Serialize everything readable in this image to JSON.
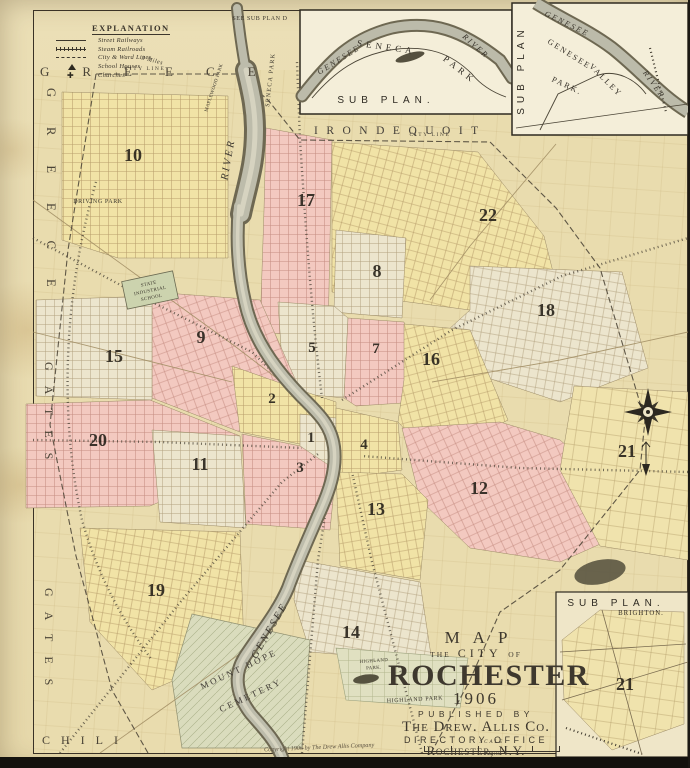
{
  "canvas": {
    "width": 690,
    "height": 768
  },
  "colors": {
    "paper": "#e9dcb2",
    "ward_yellow": "#f1e3a6",
    "ward_pink": "#f3c9c0",
    "ward_cream": "#ece5cd",
    "river_bank": "#6e6852",
    "river_fill": "#bdbcab",
    "ink": "#3c362c"
  },
  "explanation": {
    "title": "EXPLANATION",
    "items": [
      {
        "label": "Street Railways",
        "symbol": "single-line"
      },
      {
        "label": "Steam Railroads",
        "symbol": "hatched-line"
      },
      {
        "label": "City & Ward Lines",
        "symbol": "dashed-line"
      },
      {
        "label": "School Houses",
        "symbol": "triangle"
      },
      {
        "label": "Churches",
        "symbol": "cross"
      }
    ]
  },
  "townships": {
    "greece_top": "GREECE",
    "greece_left": "GREECE",
    "gates_upper": "GATES",
    "gates_lower": "GATES",
    "chili": "CHILI",
    "irondequoit": "IRONDEQUOIT"
  },
  "labels": {
    "see_sub_plan": "SEE SUB PLAN D",
    "city_line_nw": "CITY LINE",
    "city_line_ne": "CITY LINE",
    "three_miles": "3 Miles",
    "river_north": "RIVER",
    "seneca_park": "SENECA PARK",
    "maplewood_park": "MAPLEWOOD PARK",
    "driving_park": "DRIVING PARK",
    "state_industrial_1": "STATE",
    "state_industrial_2": "INDUSTRIAL",
    "state_industrial_3": "SCHOOL",
    "genesee_south": "GENESEE",
    "mount_hope_1": "MOUNT HOPE",
    "mount_hope_2": "CEMETERY",
    "highland_1a": "HIGHLAND",
    "highland_1b": "PARK.",
    "highland_2": "HIGHLAND PARK"
  },
  "wards": [
    "1",
    "2",
    "3",
    "4",
    "5",
    "7",
    "8",
    "9",
    "10",
    "11",
    "12",
    "13",
    "14",
    "15",
    "16",
    "17",
    "18",
    "19",
    "20",
    "21",
    "22"
  ],
  "sub_plans": {
    "seneca": {
      "river_1": "GENESEE",
      "river_2": "RIVER",
      "park_1": "SENECA",
      "park_2": "PARK",
      "label": "SUB PLAN."
    },
    "valley": {
      "label": "SUB PLAN",
      "river_1": "GENESEE",
      "river_2": "RIVER",
      "park_1": "GENESEE",
      "park_2": "VALLEY",
      "park_3": "PARK."
    },
    "brighton": {
      "label": "SUB PLAN.",
      "sublabel": "BRIGHTON.",
      "ward": "21"
    }
  },
  "title_block": {
    "map": "MAP",
    "the": "THE",
    "city": "CITY",
    "of": "OF",
    "name": "ROCHESTER",
    "year": "1906",
    "published_by": "PUBLISHED BY",
    "publisher": "The Drew. Allis Co.",
    "office": "DIRECTORY OFFICE",
    "city_state": "Rochester, N.Y.",
    "scale": "SCALE",
    "mile": "1 Mile",
    "copyright": "Copyright 1906 by The Drew Allis Company"
  }
}
